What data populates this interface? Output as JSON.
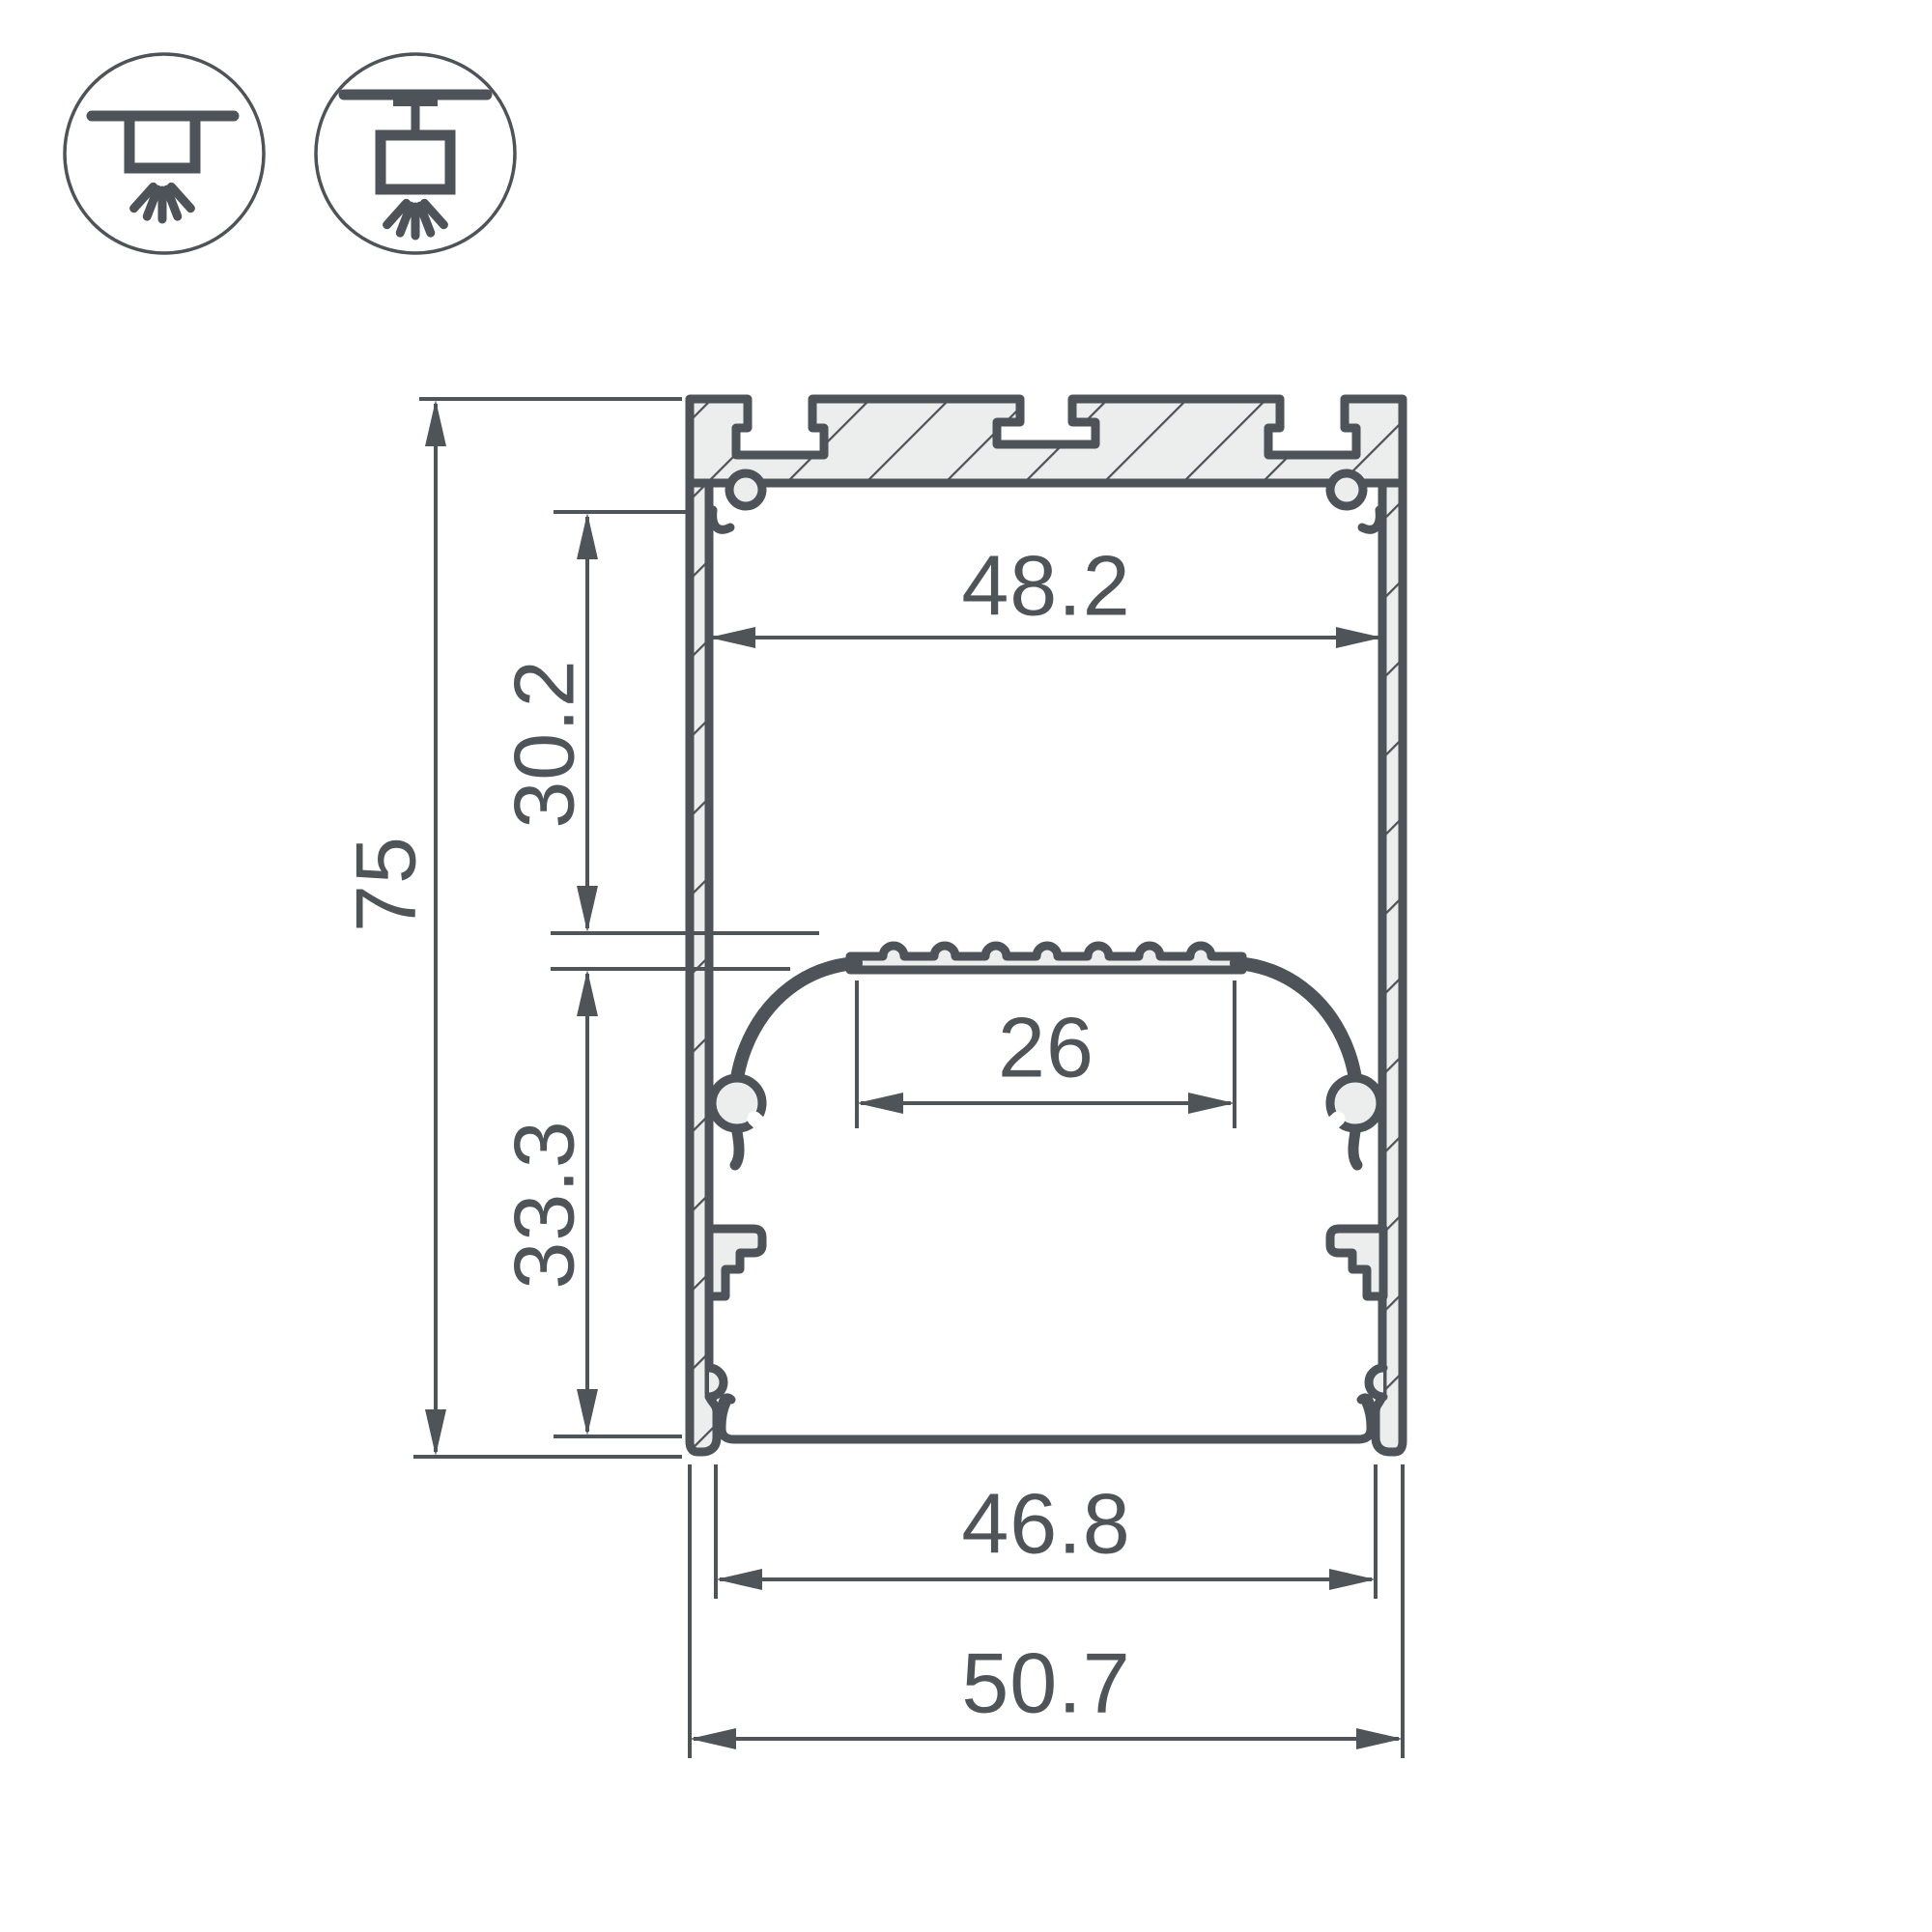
{
  "drawing": {
    "type": "profile-cross-section-dimension-drawing",
    "colors": {
      "line": "#4D5358",
      "fill_aluminum": "#ECEDED",
      "dimension_text": "#4E5458",
      "background": "#FFFFFF"
    },
    "mounting_icons": [
      {
        "name": "surface-mount-icon",
        "meaning": "surface ceiling mounting with light emitting down"
      },
      {
        "name": "pendant-mount-icon",
        "meaning": "suspended pendant mounting with light emitting down"
      }
    ],
    "dimensions": {
      "overall_height": "75",
      "upper_chamber_height": "30.2",
      "lower_chamber_height": "33.3",
      "upper_inner_width": "48.2",
      "led_shelf_width": "26",
      "bottom_opening_width": "46.8",
      "overall_width": "50.7"
    }
  }
}
